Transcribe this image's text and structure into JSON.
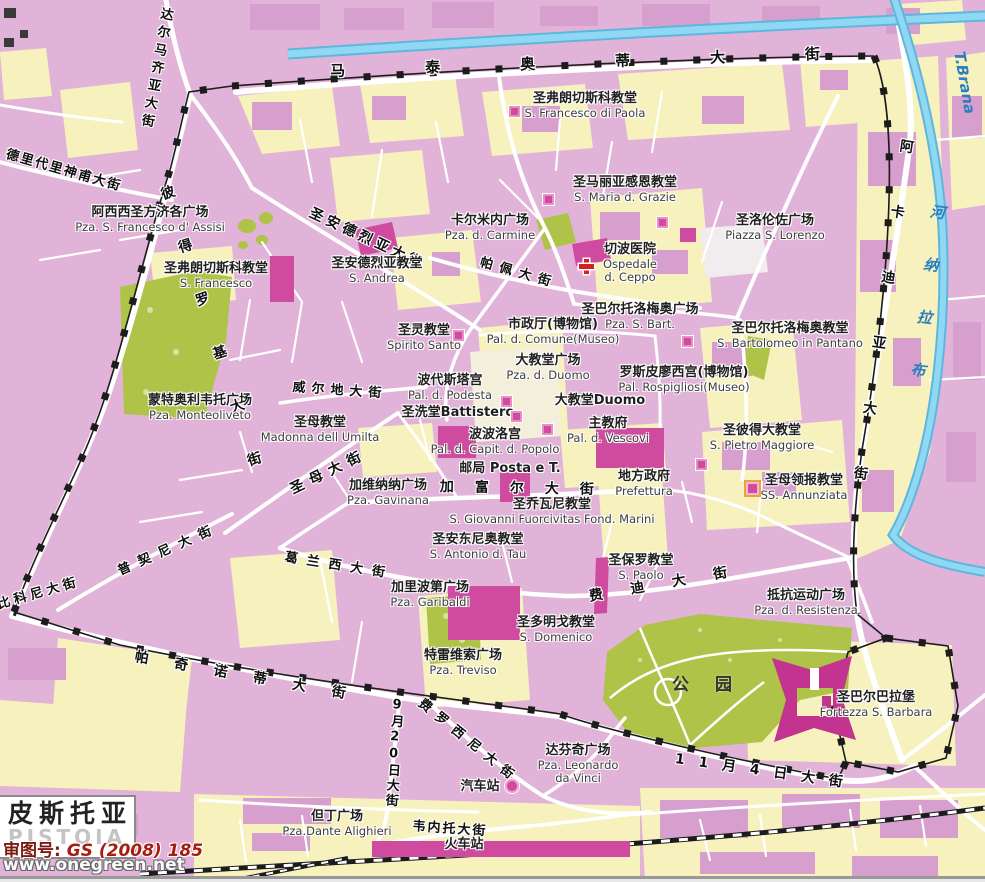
{
  "map_title": {
    "cn": "皮斯托亚",
    "en": "PISTOIA"
  },
  "credits": {
    "approval_label": "审图号:",
    "approval_number": "GS (2008) 185",
    "website": "www.onegreen.net"
  },
  "park_label": "公园",
  "river": {
    "cn_chars": "河纳拉布",
    "en": "T.Brana"
  },
  "colors": {
    "block_pink": "#e2b3d8",
    "block_yellow": "#f6f1bd",
    "park_green": "#aec347",
    "water_blue": "#8fd8f3",
    "wall_black": "#1c1c1c",
    "church_magenta": "#ce4ba0",
    "road_white": "#ffffff",
    "approval_red": "#a81b10",
    "hospital_red": "#d42020"
  },
  "streets": [
    {
      "name": "viale-matteotti",
      "text": "马泰奥蒂大街",
      "x": 330,
      "y": 64,
      "rot": -2,
      "ls": 80,
      "fs": 15
    },
    {
      "name": "viale-dalmazia",
      "text": "达尔马齐亚大街",
      "x": 160,
      "y": 6,
      "rot": 10,
      "ls": 5,
      "fs": 13,
      "vertical": true
    },
    {
      "name": "via-deidedari",
      "text": "德里代里神甫大街",
      "x": 8,
      "y": 148,
      "rot": 16,
      "ls": 2,
      "fs": 13
    },
    {
      "name": "viale-petrocchi",
      "text": "彼得罗基大街",
      "x": 158,
      "y": 188,
      "rot": -18,
      "ls": 42,
      "fs": 14,
      "vertical": true
    },
    {
      "name": "via-sant-andrea",
      "text": "圣安德烈亚大街",
      "x": 313,
      "y": 206,
      "rot": 25,
      "ls": 4,
      "fs": 14
    },
    {
      "name": "via-delle-pappe",
      "text": "帕佩大街",
      "x": 482,
      "y": 256,
      "rot": 16,
      "ls": 7,
      "fs": 13
    },
    {
      "name": "viale-arcadia",
      "text": "阿卡迪亚大街",
      "x": 900,
      "y": 138,
      "rot": 8,
      "ls": 52,
      "fs": 14,
      "vertical": true
    },
    {
      "name": "via-verdi",
      "text": "威尔地大街",
      "x": 293,
      "y": 381,
      "rot": 4,
      "ls": 6,
      "fs": 13
    },
    {
      "name": "via-della-madonna",
      "text": "圣母大街",
      "x": 288,
      "y": 484,
      "rot": -26,
      "ls": 7,
      "fs": 14
    },
    {
      "name": "via-cavour",
      "text": "加富尔大街",
      "x": 440,
      "y": 480,
      "rot": 1,
      "ls": 21,
      "fs": 14
    },
    {
      "name": "corso-gramsci",
      "text": "葛兰西大街",
      "x": 286,
      "y": 551,
      "rot": 9,
      "ls": 9,
      "fs": 13
    },
    {
      "name": "via-puccini",
      "text": "普契尼大街",
      "x": 116,
      "y": 566,
      "rot": -24,
      "ls": 9,
      "fs": 13
    },
    {
      "name": "via-biconi",
      "text": "比科尼大街",
      "x": -4,
      "y": 599,
      "rot": -16,
      "ls": 4,
      "fs": 13
    },
    {
      "name": "viale-pacinotti",
      "text": "帕奇诺蒂大街",
      "x": 136,
      "y": 650,
      "rot": 10,
      "ls": 26,
      "fs": 14
    },
    {
      "name": "viale-frosini",
      "text": "费罗西尼大街",
      "x": 424,
      "y": 697,
      "rot": 39,
      "ls": 8,
      "fs": 13
    },
    {
      "name": "via-xx-settembre",
      "text": "9月20日大街",
      "x": 391,
      "y": 697,
      "rot": 4,
      "ls": 2,
      "fs": 13,
      "vertical": true
    },
    {
      "name": "via-veneto",
      "text": "韦内托大街",
      "x": 413,
      "y": 820,
      "rot": 4,
      "ls": 2,
      "fs": 13
    },
    {
      "name": "via-iv-novembre",
      "text": "11月4日大街",
      "x": 676,
      "y": 752,
      "rot": 8,
      "ls": 14,
      "fs": 14
    },
    {
      "name": "via-fedi",
      "text": "费迪大街",
      "x": 588,
      "y": 590,
      "rot": -10,
      "ls": 28,
      "fs": 14
    }
  ],
  "places": [
    {
      "name": "s-francesco-di-paola",
      "cn": "圣弗朗切斯科教堂",
      "en": [
        "S. Francesco di Paola"
      ],
      "x": 585,
      "y": 92
    },
    {
      "name": "s-maria-delle-grazie",
      "cn": "圣马丽亚感恩教堂",
      "en": [
        "S. Maria d. Grazie"
      ],
      "x": 625,
      "y": 176
    },
    {
      "name": "piazza-s-lorenzo",
      "cn": "圣洛伦佐广场",
      "en": [
        "Piazza S. Lorenzo"
      ],
      "x": 775,
      "y": 214
    },
    {
      "name": "pza-del-carmine",
      "cn": "卡尔米内广场",
      "en": [
        "Pza. d. Carmine"
      ],
      "x": 490,
      "y": 214
    },
    {
      "name": "s-andrea",
      "cn": "圣安德烈亚教堂",
      "en": [
        "S. Andrea"
      ],
      "x": 377,
      "y": 257
    },
    {
      "name": "ospedale-del-ceppo",
      "cn": "切波医院",
      "en": [
        "Ospedale",
        "d. Ceppo"
      ],
      "x": 630,
      "y": 243
    },
    {
      "name": "pza-s-bartolomeo",
      "cn": "圣巴尔托洛梅奥广场",
      "en": [
        "Pza. S. Bart."
      ],
      "x": 640,
      "y": 303
    },
    {
      "name": "s-bartolomeo-in-pantano",
      "cn": "圣巴尔托洛梅奥教堂",
      "en": [
        "S. Bartolomeo in Pantano"
      ],
      "x": 790,
      "y": 322
    },
    {
      "name": "s-francesco",
      "cn": "圣弗朗切斯科教堂",
      "en": [
        "S. Francesco"
      ],
      "x": 216,
      "y": 262
    },
    {
      "name": "pza-s-francesco-d-assisi",
      "cn": "阿西西圣方济各广场",
      "en": [
        "Pza. S. Francesco d' Assisi"
      ],
      "x": 150,
      "y": 206
    },
    {
      "name": "pza-monteoliveto",
      "cn": "蒙特奥利韦托广场",
      "en": [
        "Pza. Monteoliveto"
      ],
      "x": 200,
      "y": 394
    },
    {
      "name": "madonna-dell-umilta",
      "cn": "圣母教堂",
      "en": [
        "Madonna dell Umilta"
      ],
      "x": 320,
      "y": 416
    },
    {
      "name": "spirito-santo",
      "cn": "圣灵教堂",
      "en": [
        "Spirito Santo"
      ],
      "x": 424,
      "y": 324
    },
    {
      "name": "pal-del-comune",
      "cn": "市政厅(博物馆)",
      "en": [
        "Pal. d. Comune(Museo)"
      ],
      "x": 553,
      "y": 318
    },
    {
      "name": "pza-del-duomo",
      "cn": "大教堂广场",
      "en": [
        "Pza. d. Duomo"
      ],
      "x": 548,
      "y": 354
    },
    {
      "name": "pal-rospigliosi",
      "cn": "罗斯皮廖西宫(博物馆)",
      "en": [
        "Pal. Rospigliosi(Museo)"
      ],
      "x": 684,
      "y": 366
    },
    {
      "name": "pal-del-podesta",
      "cn": "波代斯塔宫",
      "en": [
        "Pal. d. Podesta"
      ],
      "x": 450,
      "y": 374
    },
    {
      "name": "battistero",
      "cn": "圣洗堂Battistero",
      "en": [],
      "x": 458,
      "y": 406
    },
    {
      "name": "duomo",
      "cn": "大教堂Duomo",
      "en": [],
      "x": 600,
      "y": 394
    },
    {
      "name": "pal-dei-vescovi",
      "cn": "主教府",
      "en": [
        "Pal. d. Vescovi"
      ],
      "x": 608,
      "y": 417
    },
    {
      "name": "pal-capitano-del-popolo",
      "cn": "波波洛宫",
      "en": [
        "Pal. d. Capit. d. Popolo"
      ],
      "x": 495,
      "y": 428
    },
    {
      "name": "posta",
      "cn": "邮局 Posta e T.",
      "en": [],
      "x": 510,
      "y": 462
    },
    {
      "name": "prefettura",
      "cn": "地方政府",
      "en": [
        "Prefettura"
      ],
      "x": 644,
      "y": 470
    },
    {
      "name": "pza-gavinana",
      "cn": "加维纳纳广场",
      "en": [
        "Pza. Gavinana"
      ],
      "x": 388,
      "y": 479
    },
    {
      "name": "s-giovanni-fuorcivitas",
      "cn": "圣乔瓦尼教堂",
      "en": [
        "S. Giovanni Fuorcivitas Fond. Marini"
      ],
      "x": 552,
      "y": 498
    },
    {
      "name": "s-antonio-del-tau",
      "cn": "圣安东尼奥教堂",
      "en": [
        "S. Antonio d. Tau"
      ],
      "x": 478,
      "y": 533
    },
    {
      "name": "s-paolo",
      "cn": "圣保罗教堂",
      "en": [
        "S. Paolo"
      ],
      "x": 641,
      "y": 554
    },
    {
      "name": "pza-garibaldi",
      "cn": "加里波第广场",
      "en": [
        "Pza. Garibaldi"
      ],
      "x": 430,
      "y": 581
    },
    {
      "name": "s-domenico",
      "cn": "圣多明戈教堂",
      "en": [
        "S. Domenico"
      ],
      "x": 556,
      "y": 616
    },
    {
      "name": "pza-treviso",
      "cn": "特雷维索广场",
      "en": [
        "Pza. Treviso"
      ],
      "x": 463,
      "y": 649
    },
    {
      "name": "pza-della-resistenza",
      "cn": "抵抗运动广场",
      "en": [
        "Pza. d. Resistenza"
      ],
      "x": 806,
      "y": 589
    },
    {
      "name": "fortezza-s-barbara",
      "cn": "圣巴尔巴拉堡",
      "en": [
        "Fortezza S. Barbara"
      ],
      "x": 876,
      "y": 691
    },
    {
      "name": "s-pietro-maggiore",
      "cn": "圣彼得大教堂",
      "en": [
        "S. Pietro Maggiore"
      ],
      "x": 762,
      "y": 424
    },
    {
      "name": "ss-annunziata",
      "cn": "圣母领报教堂",
      "en": [
        "SS. Annunziata"
      ],
      "x": 804,
      "y": 474
    },
    {
      "name": "pza-leonardo-da-vinci",
      "cn": "达芬奇广场",
      "en": [
        "Pza. Leonardo",
        "da Vinci"
      ],
      "x": 578,
      "y": 744
    },
    {
      "name": "pza-dante-alighieri",
      "cn": "但丁广场",
      "en": [
        "Pza.Dante Alighieri"
      ],
      "x": 337,
      "y": 810
    },
    {
      "name": "bus-station",
      "cn": "汽车站",
      "en": [],
      "x": 480,
      "y": 780
    },
    {
      "name": "train-station",
      "cn": "火车站",
      "en": [],
      "x": 464,
      "y": 838
    }
  ],
  "markers": [
    {
      "name": "church-marker-s-francesco-paola",
      "type": "square",
      "x": 509,
      "y": 106
    },
    {
      "name": "church-marker-grazie-west",
      "type": "square",
      "x": 543,
      "y": 194
    },
    {
      "name": "church-marker-grazie-east",
      "type": "square",
      "x": 657,
      "y": 217
    },
    {
      "name": "church-marker-spirito-santo",
      "type": "square",
      "x": 453,
      "y": 330
    },
    {
      "name": "church-marker-podesta",
      "type": "square",
      "x": 501,
      "y": 396
    },
    {
      "name": "church-marker-battistero",
      "type": "square",
      "x": 511,
      "y": 411
    },
    {
      "name": "church-marker-vescovi",
      "type": "square",
      "x": 542,
      "y": 424
    },
    {
      "name": "church-marker-s-bartolomeo",
      "type": "square",
      "x": 682,
      "y": 336
    },
    {
      "name": "church-marker-s-pietro",
      "type": "square",
      "x": 696,
      "y": 459
    },
    {
      "name": "church-marker-ss-annunziata",
      "type": "square-gold",
      "x": 744,
      "y": 480
    },
    {
      "name": "hospital-cross-icon",
      "type": "cross",
      "x": 579,
      "y": 259
    },
    {
      "name": "bus-station-icon",
      "type": "circle",
      "x": 505,
      "y": 779
    }
  ]
}
